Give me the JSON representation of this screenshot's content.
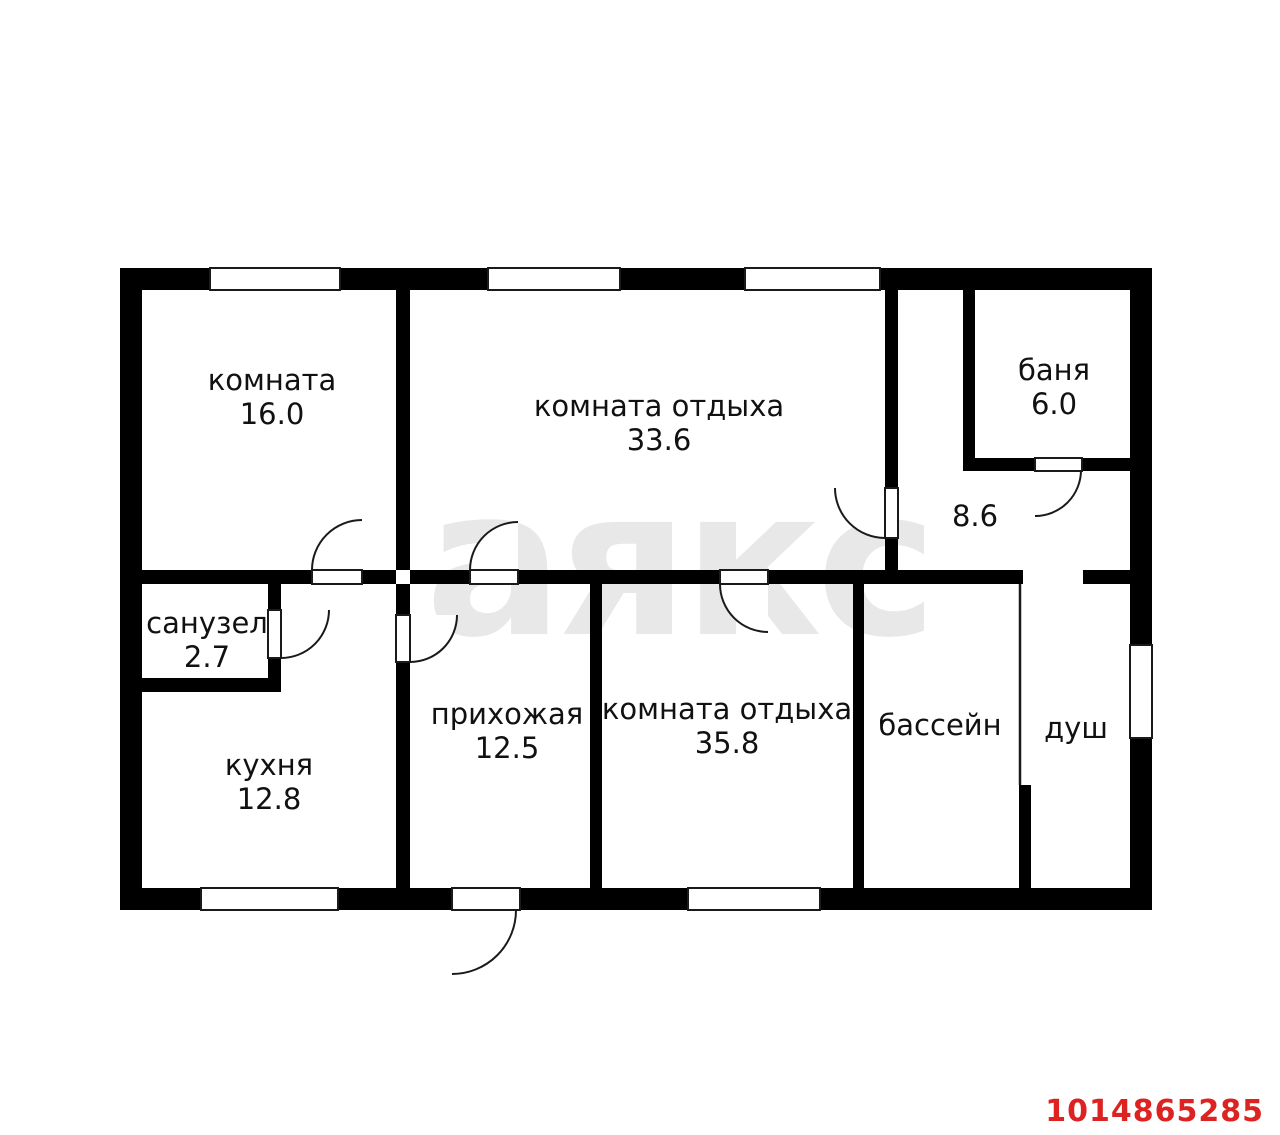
{
  "plan": {
    "watermark": "аякс",
    "listing_id": "1014865285",
    "colors": {
      "wall": "#000000",
      "background": "#ffffff",
      "watermark": "#e8e8e8",
      "listing_id_red": "#dd2222",
      "label_text": "#111111"
    },
    "rooms": [
      {
        "key": "room-16",
        "name": "комната",
        "area": "16.0"
      },
      {
        "key": "rest-room-33",
        "name": "комната отдыха",
        "area": "33.6"
      },
      {
        "key": "banya",
        "name": "баня",
        "area": "6.0"
      },
      {
        "key": "corridor-86",
        "name": "",
        "area": "8.6"
      },
      {
        "key": "sanuzel",
        "name": "санузел",
        "area": "2.7"
      },
      {
        "key": "kitchen",
        "name": "кухня",
        "area": "12.8"
      },
      {
        "key": "prihozhaya",
        "name": "прихожая",
        "area": "12.5"
      },
      {
        "key": "rest-room-35",
        "name": "комната отдыха",
        "area": "35.8"
      },
      {
        "key": "pool",
        "name": "бассейн",
        "area": ""
      },
      {
        "key": "shower",
        "name": "душ",
        "area": ""
      }
    ]
  }
}
